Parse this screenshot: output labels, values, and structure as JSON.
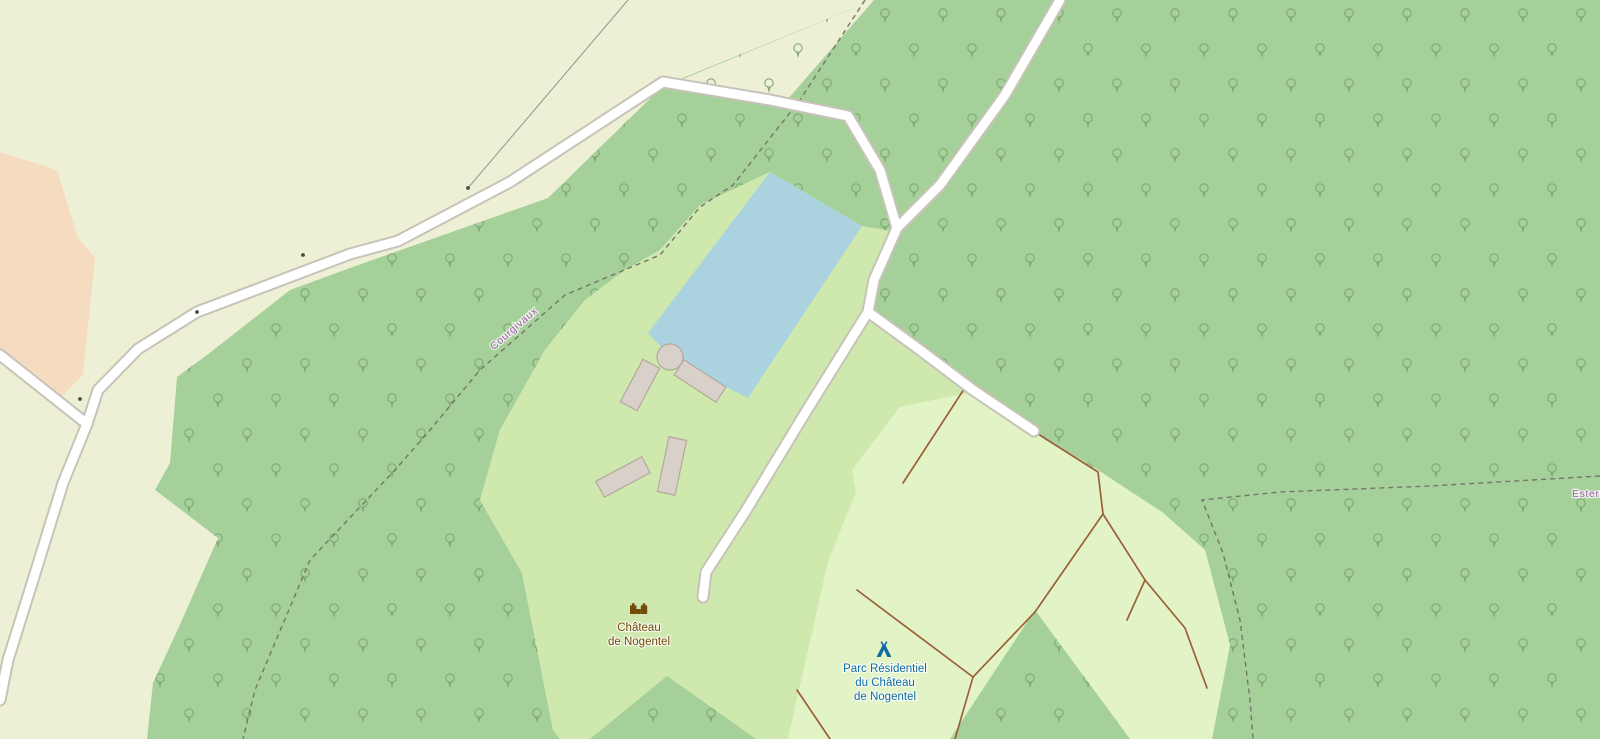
{
  "map": {
    "pois": {
      "castle": {
        "icon": "castle-icon",
        "name_line1": "Château",
        "name_line2": "de Nogentel"
      },
      "campsite": {
        "icon": "tent-icon",
        "name_line1": "Parc Résidentiel",
        "name_line2": "du Château",
        "name_line3": "de Nogentel"
      }
    },
    "boundary_labels": {
      "west": "Courgivaux",
      "east": "Estern"
    },
    "colors": {
      "farmland": "#eef0d6",
      "farmyard": "#f5dcc0",
      "forest": "#a6d099",
      "meadow": "#cfe8ae",
      "campsite": "#e2f4c5",
      "water": "#aad3df",
      "building_fill": "#d9d0c9",
      "building_stroke": "#b3a89c",
      "road_fill": "#ffffff",
      "road_casing": "#c7c3b8",
      "track": "#9a6038",
      "path_dash": "#75766a",
      "fence": "#9a9a94",
      "boundary_text": "#9c59a3",
      "castle_text": "#734a08",
      "campsite_text": "#0d6ba5",
      "tree": "#7ea773",
      "gate_dot": "#4a4a45"
    }
  }
}
